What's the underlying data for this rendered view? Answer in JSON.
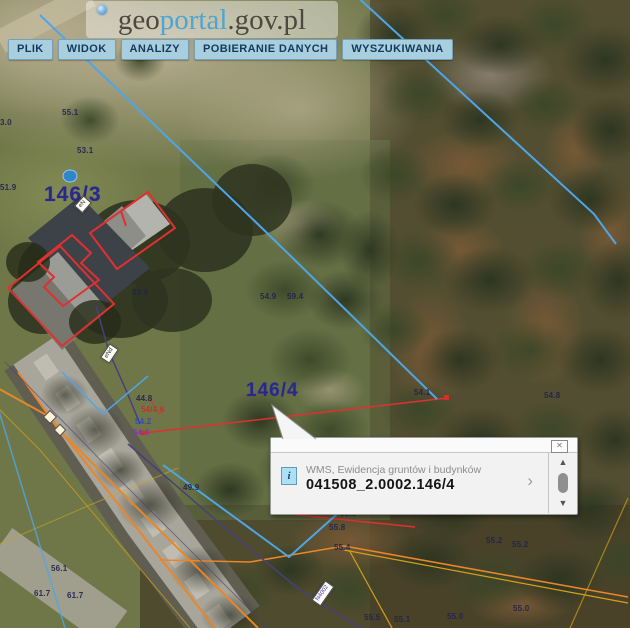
{
  "header": {
    "logo": {
      "part1": "geo",
      "part2": "portal",
      "part3": ".gov.pl"
    },
    "menu": {
      "items": [
        {
          "label": "PLIK"
        },
        {
          "label": "WIDOK"
        },
        {
          "label": "ANALIZY"
        },
        {
          "label": "POBIERANIE DANYCH"
        },
        {
          "label": "WYSZUKIWANIA"
        }
      ]
    }
  },
  "popup": {
    "source_line": "WMS, Ewidencja gruntów i budynków",
    "feature_id": "041508_2.0002.146/4",
    "close_icon": "✕",
    "chevron_icon": "›",
    "info_icon": "i",
    "scroll_up_icon": "▲",
    "scroll_down_icon": "▼"
  },
  "map": {
    "label_colors": {
      "dark": "#23234f",
      "red": "#c13226",
      "blue": "#2f49c4",
      "purple": "#8033b0"
    },
    "parcel_labels": [
      {
        "t": "146/3",
        "x": 44,
        "y": 183,
        "size": 21
      },
      {
        "t": "146/4",
        "x": 246,
        "y": 380,
        "size": 19
      }
    ],
    "elevation_labels": [
      {
        "t": "55.1",
        "x": 62,
        "y": 108
      },
      {
        "t": "3.0",
        "x": 0,
        "y": 118
      },
      {
        "t": "53.1",
        "x": 77,
        "y": 146
      },
      {
        "t": "51.9",
        "x": 0,
        "y": 183
      },
      {
        "t": "53.9",
        "x": 132,
        "y": 288
      },
      {
        "t": "54.9",
        "x": 260,
        "y": 292
      },
      {
        "t": "59.4",
        "x": 287,
        "y": 292
      },
      {
        "t": "54.1",
        "x": 414,
        "y": 388
      },
      {
        "t": "54.8",
        "x": 544,
        "y": 391
      },
      {
        "t": "44.8",
        "x": 136,
        "y": 394
      },
      {
        "t": "54/4.6",
        "x": 141,
        "y": 405,
        "c": "red"
      },
      {
        "t": "54.2",
        "x": 135,
        "y": 417,
        "c": "blue"
      },
      {
        "t": "54.6",
        "x": 133,
        "y": 428,
        "c": "purple"
      },
      {
        "t": "49.9",
        "x": 183,
        "y": 483
      },
      {
        "t": "55.6",
        "x": 340,
        "y": 509
      },
      {
        "t": "55.8",
        "x": 329,
        "y": 523
      },
      {
        "t": "55.4",
        "x": 334,
        "y": 543
      },
      {
        "t": "55.2",
        "x": 486,
        "y": 536
      },
      {
        "t": "55.2",
        "x": 512,
        "y": 540
      },
      {
        "t": "56.1",
        "x": 51,
        "y": 564
      },
      {
        "t": "61.7",
        "x": 34,
        "y": 589
      },
      {
        "t": "61.7",
        "x": 67,
        "y": 591
      },
      {
        "t": "55.5",
        "x": 364,
        "y": 613
      },
      {
        "t": "55.1",
        "x": 394,
        "y": 615
      },
      {
        "t": "55.0",
        "x": 447,
        "y": 612
      },
      {
        "t": "55.0",
        "x": 513,
        "y": 604
      }
    ],
    "plates": [
      {
        "t": "eN",
        "x": 76,
        "y": 199,
        "rot": -48
      },
      {
        "t": "eNd",
        "x": 101,
        "y": 348,
        "rot": -56
      },
      {
        "t": "N4002",
        "x": 311,
        "y": 588,
        "rot": -55,
        "c": "#4433bb"
      }
    ],
    "overlay_colors": {
      "parcel_boundary": "#4da6e8",
      "building_outline": "#e03030",
      "utility_orange": "#e8862a",
      "utility_yellow": "#d4a017",
      "utility_purple": "#46417a"
    }
  }
}
